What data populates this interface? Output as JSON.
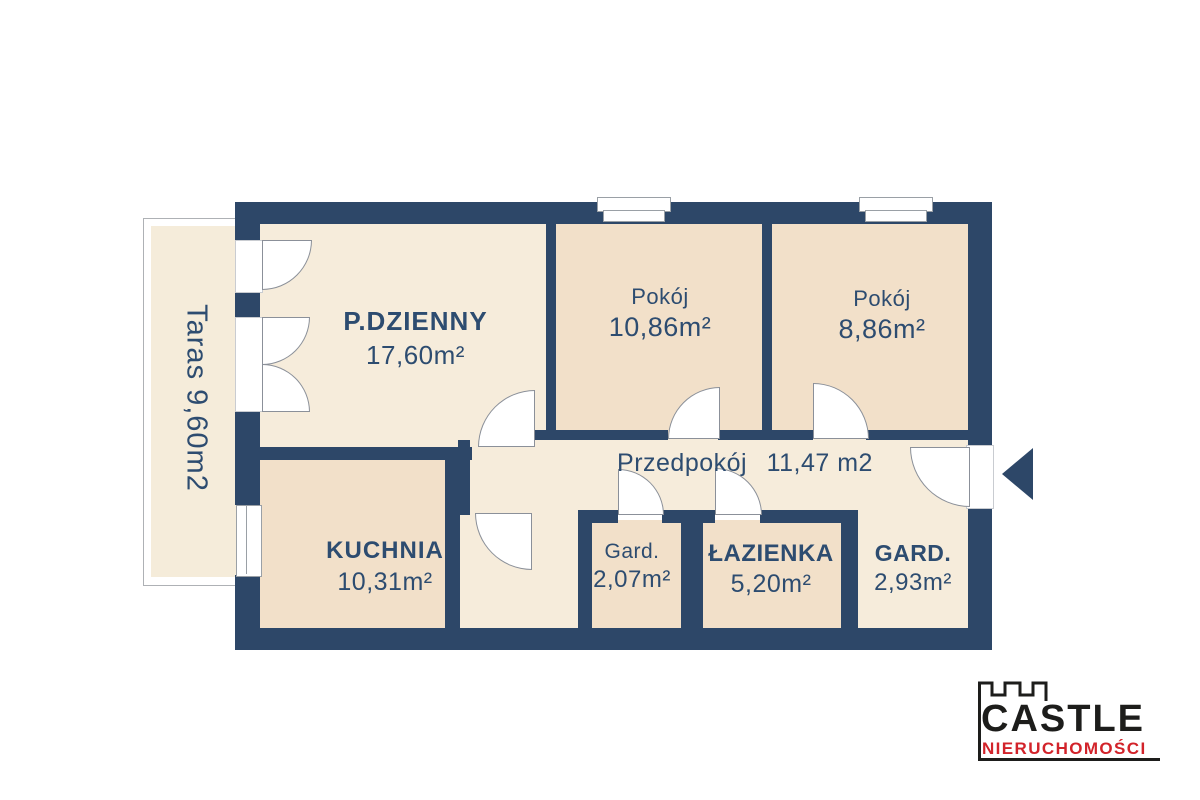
{
  "plan": {
    "terrace": {
      "label": "Taras 9,60m2"
    },
    "rooms": {
      "living": {
        "name": "P.DZIENNY",
        "area": "17,60m²"
      },
      "room1": {
        "name": "Pokój",
        "area": "10,86m²"
      },
      "room2": {
        "name": "Pokój",
        "area": "8,86m²"
      },
      "hallway": {
        "name": "Przedpokój",
        "area": "11,47 m2"
      },
      "kitchen": {
        "name": "KUCHNIA",
        "area": "10,31m²"
      },
      "wardrobe1": {
        "name": "Gard.",
        "area": "2,07m²"
      },
      "bathroom": {
        "name": "ŁAZIENKA",
        "area": "5,20m²"
      },
      "wardrobe2": {
        "name": "GARD.",
        "area": "2,93m²"
      }
    },
    "colors": {
      "wall": "#2d4768",
      "room_light": "#f6ecdb",
      "room_dark": "#f2e0c9",
      "label": "#2d4c70",
      "door": "#ffffff"
    }
  },
  "branding": {
    "name": "CASTLE",
    "tagline": "NIERUCHOMOŚCI",
    "name_color": "#1d1d1b",
    "tagline_color": "#d2232a"
  }
}
